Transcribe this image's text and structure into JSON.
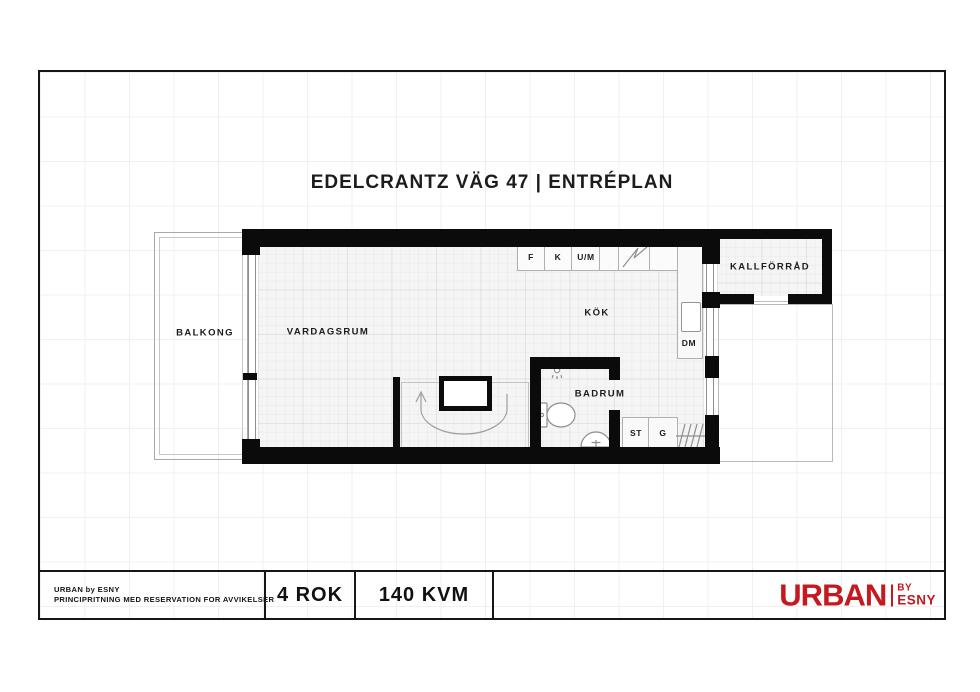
{
  "title": "EDELCRANTZ VÄG 47 | ENTRÉPLAN",
  "plan": {
    "rooms": {
      "balkong": "BALKONG",
      "vardagsrum": "VARDAGSRUM",
      "kok": "KÖK",
      "badrum": "BADRUM",
      "kallforrad": "KALLFÖRRÅD"
    },
    "labels": {
      "f": "F",
      "k": "K",
      "um": "U/M",
      "dm": "DM",
      "st": "ST",
      "g": "G"
    },
    "icons": {
      "stove": "stove-zigzag",
      "shower": "shower-head",
      "toilet": "toilet",
      "washbasin": "washbasin",
      "stairs": "stairs-up-arrow",
      "hanger_rail": "wardrobe-hanger-rail"
    }
  },
  "footer": {
    "company": "URBAN by ESNY",
    "disclaimer": "PRINCIPRITNING MED RESERVATION FOR AVVIKELSER",
    "rooms_count": "4 ROK",
    "area": "140 KVM"
  },
  "logo": {
    "brand": "URBAN",
    "by": "BY",
    "name": "ESNY"
  },
  "colors": {
    "wall_black": "#0b0b0b",
    "logo_red": "#C4191E",
    "line_gray": "#8f8f8f"
  }
}
